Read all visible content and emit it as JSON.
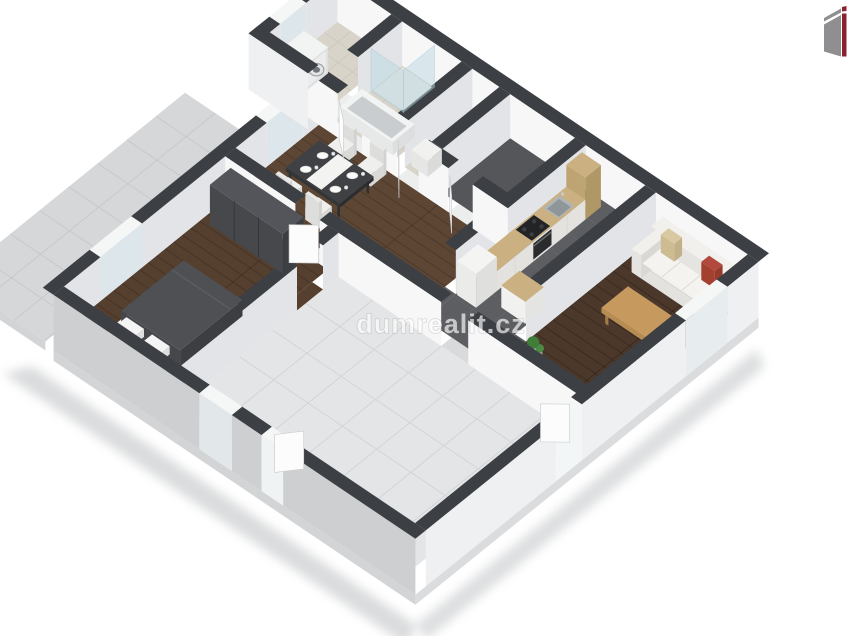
{
  "watermark": {
    "text": "dumrealit.cz",
    "color": "#ffffff",
    "opacity": 0.66
  },
  "branding": {
    "logo": "dumrealit-logo",
    "logo_colors": {
      "gray": "#8f8f91",
      "red": "#8e2130"
    }
  },
  "scene": {
    "type": "floor-plan-3d",
    "style": "isometric-cutaway",
    "background": "#ffffff",
    "palette": {
      "wall_top": "#3c3f44",
      "wall_face_light": "#f7f7f8",
      "wall_face_shade": "#e2e4e7",
      "wall_outer_sw": "#cdcfd1",
      "wall_outer_se": "#eff0f2",
      "slab_edge": "#d3d4d6",
      "floor_tile_large": "#e4e5e7",
      "grout_large": "#d2d3d5",
      "floor_tile_terrace": "#d6d7d9",
      "grout_terrace": "#c6c7c9",
      "floor_tile_bath": "#d8d4ca",
      "grout_bath": "#c7c3b8",
      "floor_carpet": "#55565a",
      "floor_kitchen": "#5d5e62",
      "wood_dining": "#5d4634",
      "wood_bedroom": "#553f2f",
      "wood_living": "#4b382a",
      "kitchen_counter_wood": "#cbb181",
      "cabinet_front": "#f0efec",
      "appliance_white": "#f4f4f2",
      "cooktop_black": "#232426",
      "steel": "#aeb4b8",
      "sofa": "#efeeea",
      "pillow_red": "#b2493c",
      "pillow_beige": "#d9c9a3",
      "coffee_table_wood": "#c69a5e",
      "duvet": "#4e5054",
      "wardrobe": "#46484c",
      "plant_green": "#3f7d38",
      "glass": "#bcd9e4",
      "window_frame": "#f5f6f6",
      "door_leaf": "#fcfcfc"
    },
    "rooms": [
      {
        "name": "laundry-bathroom",
        "floor": "tile"
      },
      {
        "name": "shower-bathroom",
        "floor": "tile"
      },
      {
        "name": "hall",
        "floor": "tile"
      },
      {
        "name": "storage-room",
        "floor": "carpet"
      },
      {
        "name": "kitchen-corridor",
        "floor": "dark-tile"
      },
      {
        "name": "dining-area",
        "floor": "wood"
      },
      {
        "name": "living-room",
        "floor": "wood"
      },
      {
        "name": "bedroom",
        "floor": "wood"
      },
      {
        "name": "large-empty-room",
        "floor": "large-tile"
      },
      {
        "name": "terrace",
        "floor": "tile"
      }
    ],
    "furniture": [
      "washing-machine",
      "shower-enclosure",
      "bathtub",
      "dining-table",
      "dining-chairs",
      "plates",
      "kitchen-counter",
      "sink",
      "cooktop",
      "oven",
      "fridge",
      "tall-cabinet",
      "bar-counter",
      "sofa",
      "decorative-pillows",
      "coffee-table",
      "plant",
      "wardrobe",
      "double-bed",
      "pillows",
      "nightstand"
    ]
  }
}
